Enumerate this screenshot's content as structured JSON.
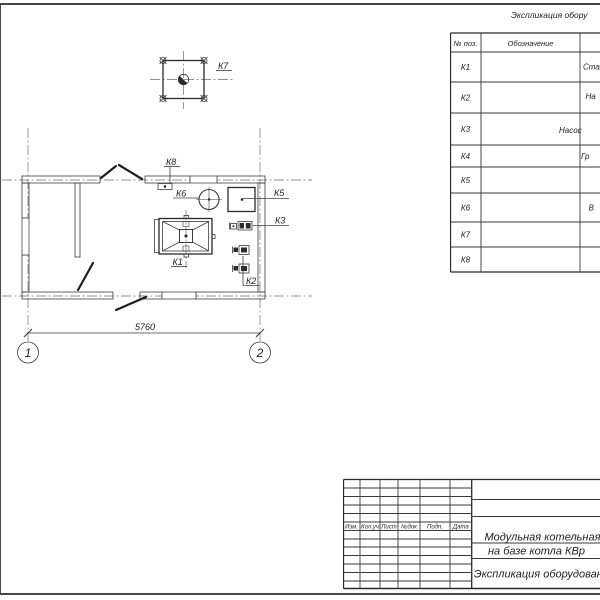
{
  "drawing": {
    "spec_table": {
      "title": "Экспликация обору",
      "headers": {
        "pos": "№ поз.",
        "designation": "Обозначение"
      },
      "rows": [
        {
          "pos": "К1",
          "name_fragment": "Стал"
        },
        {
          "pos": "К2",
          "name_fragment": "На"
        },
        {
          "pos": "К3",
          "name_fragment": "Насос"
        },
        {
          "pos": "К4",
          "name_fragment": "Гр"
        },
        {
          "pos": "К5",
          "name_fragment": ""
        },
        {
          "pos": "К6",
          "name_fragment": "В"
        },
        {
          "pos": "К7",
          "name_fragment": ""
        },
        {
          "pos": "К8",
          "name_fragment": ""
        }
      ]
    },
    "plan": {
      "equipment_labels": {
        "k1": "К1",
        "k2": "К2",
        "k3": "К3",
        "k5": "К5",
        "k6": "К6",
        "k7": "К7",
        "k8": "К8"
      },
      "dimension_5760": "5760",
      "axis_marks": {
        "a1": "1",
        "a2": "2"
      }
    },
    "title_block": {
      "col_headers": [
        "Изм.",
        "Кол.уч",
        "Лист",
        "№док",
        "Подп.",
        "Дата"
      ],
      "project_title_line1": "Модульная котельная",
      "project_title_line2": "на базе котла КВр",
      "sheet_name": "Экспликация оборудован"
    }
  }
}
